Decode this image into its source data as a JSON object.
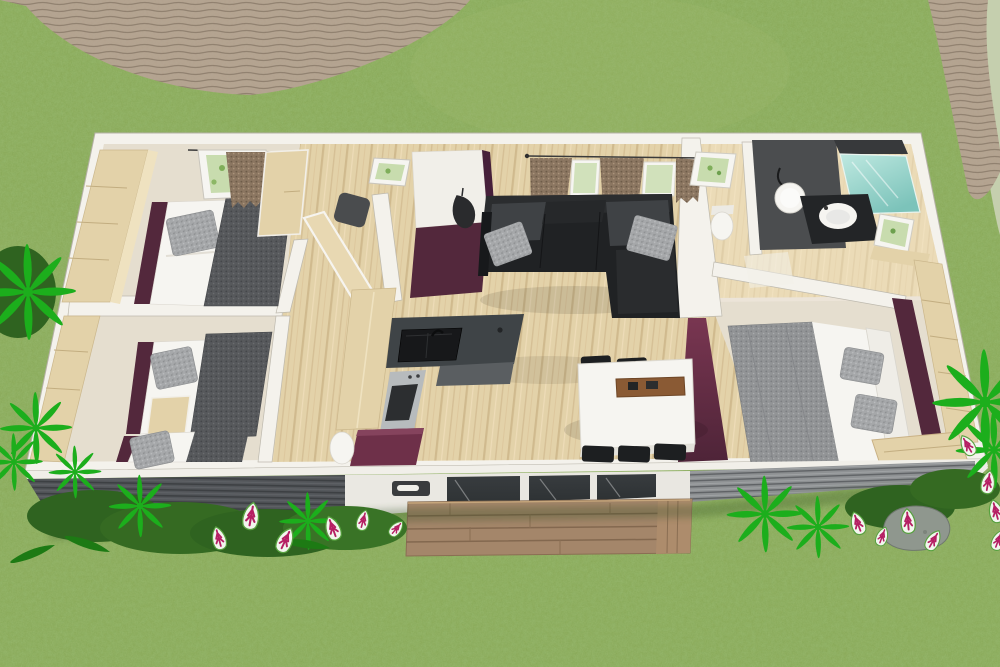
{
  "meta": {
    "type": "3d-floor-plan-render",
    "view": "aerial cutaway of a holiday lodge / mobile home set in a garden",
    "canvas": {
      "width": 1000,
      "height": 667
    }
  },
  "colors": {
    "grass": "#85a654",
    "grass-light": "#a9c179",
    "sage": "#c5cfae",
    "stone": "#b3a28e",
    "stone-dark": "#8f7f6c",
    "wall-white": "#f4f2ec",
    "wall-edge": "#bdb9ae",
    "floor-cream": "#ece4d8",
    "floor-bedroom": "#e5decf",
    "wood": "#e3d2a9",
    "wood-dark": "#c9b185",
    "plum": "#53283c",
    "plum-bright": "#6e3049",
    "charcoal": "#222325",
    "sofa-black": "#202224",
    "sofa-cushion": "#3f4245",
    "pillow-gray": "#a6a8aa",
    "blanket-gray": "#57595c",
    "counter": "#3f4447",
    "sink-black": "#17181a",
    "steel": "#b7bbbd",
    "siding-dark": "#53565a",
    "siding-light": "#8e9193",
    "glass-dark": "#2e3234",
    "deck": "#a4866a",
    "deck-dark": "#7f664e",
    "teal": "#7cc3ba",
    "teal-light": "#bfe9e1",
    "fern-bright": "#1cae1c",
    "fern-dark": "#1d7a14",
    "bush": "#2f6320",
    "flower-white": "#f2f6ee",
    "flower-magenta": "#b51f63",
    "rock": "#8f978e",
    "curtain": "#8b7661",
    "window-green": "#c8dcae",
    "soft-white": "#f6f5f1"
  },
  "scene": {
    "environment": {
      "ground": "grass lawn",
      "paths": [
        "curved stone path, top-left",
        "diagonal stone path, top-right corner"
      ],
      "plants": [
        "bright green ferns",
        "dark shrubs",
        "white-and-magenta caladium leaves",
        "gray rock"
      ]
    },
    "building": {
      "rooms": [
        {
          "name": "master-bedroom",
          "furniture": [
            "wardrobe",
            "double bed with gray pillow and dark throw",
            "plum headboard wall",
            "window with brown curtain and planter",
            "dresser"
          ]
        },
        {
          "name": "kids-bedroom",
          "furniture": [
            "two single beds",
            "wardrobe",
            "nightstand",
            "plum headboard panels"
          ]
        },
        {
          "name": "entry-hall",
          "furniture": [
            "plum accent wall",
            "coat rack",
            "green wall picture",
            "open wood door",
            "dark stool"
          ]
        },
        {
          "name": "kitchen",
          "furniture": [
            "tall cabinet",
            "L-shaped dark counter",
            "black sink with faucet",
            "stainless oven",
            "plum island",
            "white bin"
          ]
        },
        {
          "name": "living-room",
          "furniture": [
            "black corner sofa",
            "gray cushions",
            "two windows with brown curtains",
            "curtain rod"
          ]
        },
        {
          "name": "dining-area",
          "furniture": [
            "white table",
            "six black chairs",
            "brown serving tray"
          ]
        },
        {
          "name": "bathroom",
          "furniture": [
            "dark feature wall",
            "round mirror",
            "wall lamp",
            "black vanity with round basin",
            "teal shower",
            "window with greenery",
            "wood ledge"
          ]
        },
        {
          "name": "wc",
          "furniture": [
            "toilet",
            "small window with greenery"
          ]
        },
        {
          "name": "second-bedroom",
          "furniture": [
            "double bed with speckled gray cover",
            "two pillows",
            "white headboard",
            "plum wall",
            "wardrobe",
            "wood bench"
          ]
        }
      ],
      "facade": {
        "segments": [
          "dark slatted siding",
          "white panel with recessed handle",
          "three-pane glass sliding door",
          "gray slatted siding",
          "white end panel"
        ]
      },
      "deck": "wooden deck steps in front of the sliding door"
    }
  }
}
